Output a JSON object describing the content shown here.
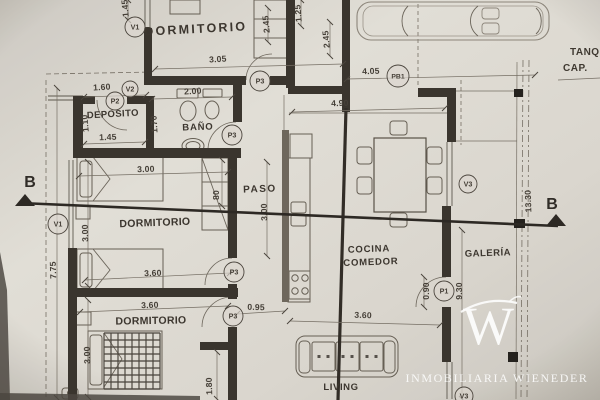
{
  "watermark": {
    "monogram": "W",
    "agency": "INMOBILIARIA WIENEDER"
  },
  "section": {
    "label": "B"
  },
  "notes": [
    {
      "text": "TANQ",
      "x": 570,
      "y": 55
    },
    {
      "text": "CAP.",
      "x": 563,
      "y": 71
    }
  ],
  "rooms": [
    {
      "text": "DORMITORIO",
      "x": 196,
      "y": 33,
      "fs": 12.5,
      "ls": 2.2,
      "rot": -3
    },
    {
      "text": "DEPOSITO",
      "x": 113,
      "y": 117,
      "fs": 9.5,
      "ls": 0.4,
      "rot": -3
    },
    {
      "text": "BAÑO",
      "x": 198,
      "y": 130,
      "fs": 9.5,
      "ls": 0.8,
      "rot": -2
    },
    {
      "text": "PASO",
      "x": 260,
      "y": 192,
      "fs": 10,
      "ls": 1.5,
      "rot": -2
    },
    {
      "text": "DORMITORIO",
      "x": 155,
      "y": 226,
      "fs": 10.5,
      "ls": 0.3,
      "rot": -2
    },
    {
      "text": "DORMITORIO",
      "x": 151,
      "y": 324,
      "fs": 10.5,
      "ls": 0.3,
      "rot": -1
    },
    {
      "text": "COCINA",
      "x": 369,
      "y": 252,
      "fs": 9.5,
      "ls": 0.8,
      "rot": -2
    },
    {
      "text": "COMEDOR",
      "x": 371,
      "y": 265,
      "fs": 9.5,
      "ls": 0.8,
      "rot": -2
    },
    {
      "text": "GALERÍA",
      "x": 488,
      "y": 256,
      "fs": 9.5,
      "ls": 0.5,
      "rot": -2
    },
    {
      "text": "LIVING",
      "x": 341,
      "y": 390,
      "fs": 9.5,
      "ls": 0.6,
      "rot": 0
    }
  ],
  "dimensions": [
    {
      "text": "3.05",
      "x": 218,
      "y": 62,
      "rot": -3
    },
    {
      "text": "4.05",
      "x": 371,
      "y": 74,
      "rot": -2
    },
    {
      "text": "4.90",
      "x": 340,
      "y": 106,
      "rot": -2
    },
    {
      "text": "1.60",
      "x": 102,
      "y": 90,
      "rot": -3
    },
    {
      "text": "2.00",
      "x": 193,
      "y": 94,
      "rot": -3
    },
    {
      "text": "1.45",
      "x": 108,
      "y": 140,
      "rot": -2
    },
    {
      "text": "3.00",
      "x": 146,
      "y": 172,
      "rot": -2
    },
    {
      "text": "3.60",
      "x": 153,
      "y": 276,
      "rot": -2
    },
    {
      "text": "3.60",
      "x": 150,
      "y": 308,
      "rot": -2
    },
    {
      "text": "0.95",
      "x": 256,
      "y": 310,
      "rot": 2
    },
    {
      "text": "3.60",
      "x": 363,
      "y": 318,
      "rot": 2
    },
    {
      "text": "1.70",
      "x": 157,
      "y": 124,
      "rot": -93
    },
    {
      "text": "1.10",
      "x": 88,
      "y": 123,
      "rot": -95
    },
    {
      "text": "80",
      "x": 219,
      "y": 195,
      "rot": -90
    },
    {
      "text": "3.00",
      "x": 267,
      "y": 212,
      "rot": -92
    },
    {
      "text": "3.00",
      "x": 88,
      "y": 233,
      "rot": -92
    },
    {
      "text": "7.75",
      "x": 56,
      "y": 270,
      "rot": -92
    },
    {
      "text": "3.00",
      "x": 90,
      "y": 355,
      "rot": -92
    },
    {
      "text": "1.80",
      "x": 212,
      "y": 386,
      "rot": -92
    },
    {
      "text": "0.90",
      "x": 429,
      "y": 291,
      "rot": -90
    },
    {
      "text": "9.30",
      "x": 462,
      "y": 291,
      "rot": -90
    },
    {
      "text": "13.30",
      "x": 531,
      "y": 201,
      "rot": -92
    },
    {
      "text": "2.45",
      "x": 269,
      "y": 24,
      "rot": -95
    },
    {
      "text": "1.25",
      "x": 301,
      "y": 13,
      "rot": -95
    },
    {
      "text": "2.45",
      "x": 329,
      "y": 39,
      "rot": -95
    },
    {
      "text": "1.45",
      "x": 128,
      "y": 8,
      "rot": -95
    }
  ],
  "tags": [
    {
      "text": "V1",
      "x": 135,
      "y": 27,
      "r": 10
    },
    {
      "text": "V1",
      "x": 58,
      "y": 224,
      "r": 10
    },
    {
      "text": "V2",
      "x": 130,
      "y": 89,
      "r": 8
    },
    {
      "text": "P2",
      "x": 115,
      "y": 101,
      "r": 9
    },
    {
      "text": "P3",
      "x": 260,
      "y": 81,
      "r": 10
    },
    {
      "text": "P3",
      "x": 232,
      "y": 135,
      "r": 10
    },
    {
      "text": "P3",
      "x": 234,
      "y": 272,
      "r": 10
    },
    {
      "text": "P3",
      "x": 233,
      "y": 316,
      "r": 10
    },
    {
      "text": "PB1",
      "x": 398,
      "y": 76,
      "r": 11
    },
    {
      "text": "P1",
      "x": 444,
      "y": 291,
      "r": 10
    },
    {
      "text": "V3",
      "x": 468,
      "y": 184,
      "r": 9
    },
    {
      "text": "V3",
      "x": 464,
      "y": 396,
      "r": 9
    }
  ],
  "colors": {
    "paper": "#dbd7cf",
    "wall": "#39332c",
    "gray_wall": "#6e665b",
    "thin_line": "#756e63",
    "ink": "#443e36",
    "section": "#2b2722",
    "watermark": "#ffffff"
  }
}
